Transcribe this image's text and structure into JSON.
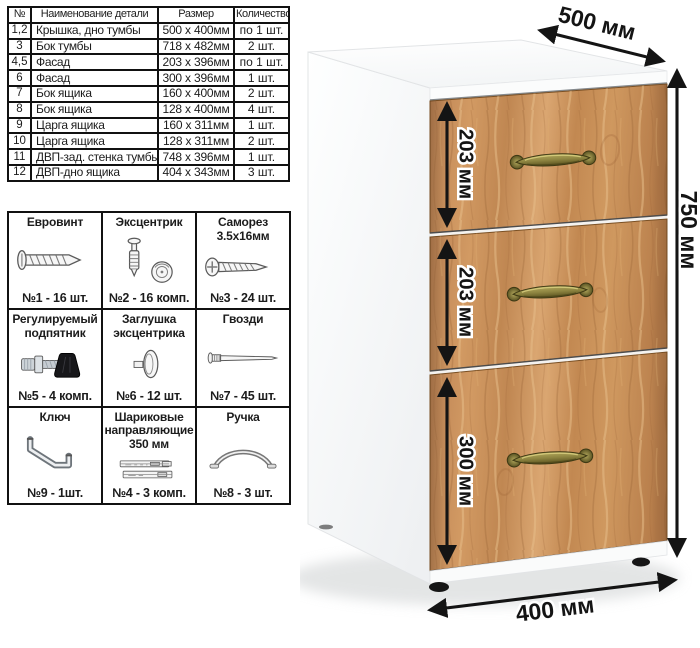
{
  "parts_table": {
    "headers": [
      "№",
      "Наименование детали",
      "Размер",
      "Количество"
    ],
    "rows": [
      [
        "1,2",
        "Крышка, дно тумбы",
        "500 x 400мм",
        "по 1 шт."
      ],
      [
        "3",
        "Бок тумбы",
        "718 x 482мм",
        "2 шт."
      ],
      [
        "4,5",
        "Фасад",
        "203 x 396мм",
        "по 1 шт."
      ],
      [
        "6",
        "Фасад",
        "300 x 396мм",
        "1 шт."
      ],
      [
        "7",
        "Бок ящика",
        "160 x 400мм",
        "2 шт."
      ],
      [
        "8",
        "Бок ящика",
        "128 x 400мм",
        "4 шт."
      ],
      [
        "9",
        "Царга ящика",
        "160 x 311мм",
        "1 шт."
      ],
      [
        "10",
        "Царга ящика",
        "128 x 311мм",
        "2 шт."
      ],
      [
        "11",
        "ДВП-зад. стенка тумбы",
        "748 x 396мм",
        "1 шт."
      ],
      [
        "12",
        "ДВП-дно ящика",
        "404 x 343мм",
        "3 шт."
      ]
    ]
  },
  "hardware": {
    "items": [
      {
        "name": "Евровинт",
        "count": "№1 - 16 шт.",
        "icon": "euro-screw"
      },
      {
        "name": "Эксцентрик",
        "count": "№2 - 16 комп.",
        "icon": "cam-lock"
      },
      {
        "name": "Саморез 3.5х16мм",
        "count": "№3 - 24 шт.",
        "icon": "self-tapping-screw"
      },
      {
        "name": "Регулируемый подпятник",
        "count": "№5 - 4 комп.",
        "icon": "adjustable-foot"
      },
      {
        "name": "Заглушка эксцентрика",
        "count": "№6 - 12 шт.",
        "icon": "cam-cover"
      },
      {
        "name": "Гвозди",
        "count": "№7 - 45 шт.",
        "icon": "nail"
      },
      {
        "name": "Ключ",
        "count": "№9 - 1шт.",
        "icon": "hex-key"
      },
      {
        "name": "Шариковые направляющие 350 мм",
        "count": "№4 - 3 комп.",
        "icon": "ball-bearing-slides"
      },
      {
        "name": "Ручка",
        "count": "№8 - 3 шт.",
        "icon": "arch-handle"
      }
    ]
  },
  "cabinet": {
    "dimensions": {
      "depth": "500 мм",
      "height": "750 мм",
      "width": "400 мм",
      "drawer_top": "203 мм",
      "drawer_middle": "203 мм",
      "drawer_bottom": "300 мм"
    },
    "colors": {
      "body": "#ffffff",
      "wood": "#c28a58",
      "wood_light": "#dcae7d",
      "wood_dark": "#9a6a3e",
      "handle_brass": "#8d8440",
      "dimension_lines": "#141414",
      "table_border": "#111111"
    }
  }
}
